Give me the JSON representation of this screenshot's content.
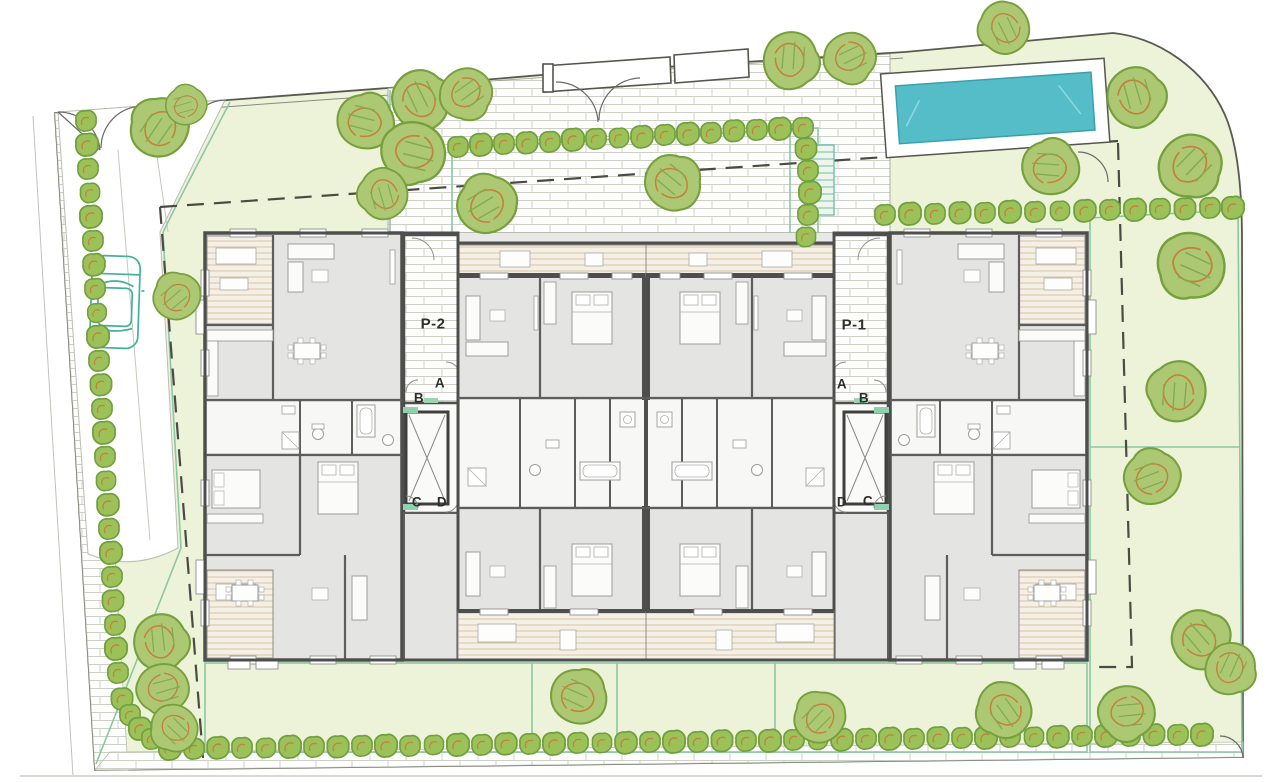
{
  "labels": {
    "p2": "P-2",
    "p1": "P-1",
    "p2_doors": {
      "a": "A",
      "b": "B",
      "c": "C",
      "d": "D"
    },
    "p1_doors": {
      "a": "A",
      "b": "B",
      "c": "C",
      "d": "D"
    }
  },
  "colors": {
    "lawn": "#edf3d8",
    "paving_joint": "#ccd0c5",
    "pool_water": "#55bdc8",
    "pool_edge": "#3aa0ad",
    "tree_canopy": "#adc873",
    "tree_outline": "#76a03d",
    "tree_detail": "#c4803c",
    "hedge": "#9cc159",
    "garden_border": "#8cc7a4",
    "building_wall": "#4e4e4c",
    "room_floor": "#e4e4e3",
    "deck_board": "#d8c4a6",
    "car_outline": "#45b09a",
    "boundary": "#59594f",
    "setback_dash": "#4b4b43"
  }
}
